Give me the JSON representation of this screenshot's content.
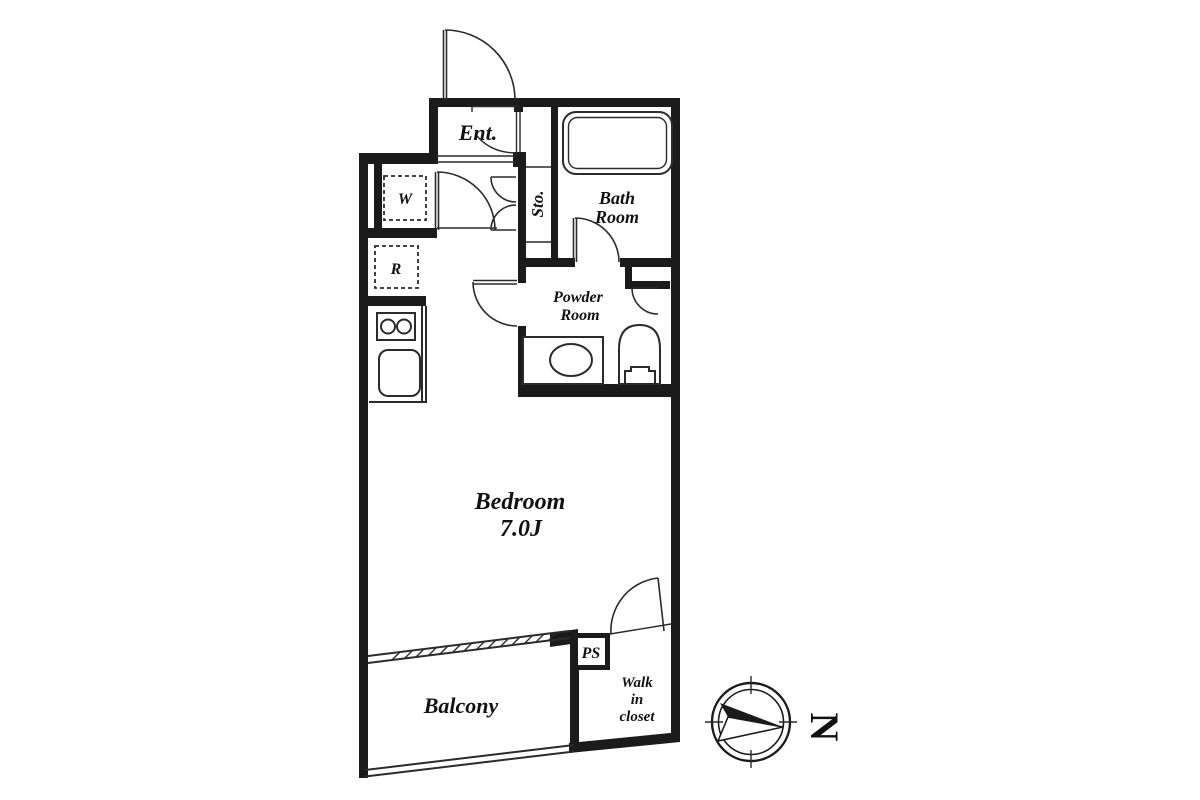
{
  "floorplan": {
    "labels": {
      "entrance": "Ent.",
      "storage": "Sto.",
      "bath_line1": "Bath",
      "bath_line2": "Room",
      "powder_line1": "Powder",
      "powder_line2": "Room",
      "bedroom_line1": "Bedroom",
      "bedroom_line2": "7.0J",
      "balcony": "Balcony",
      "pipe_shaft": "PS",
      "walkin_line1": "Walk",
      "walkin_line2": "in",
      "walkin_line3": "closet",
      "washing_machine": "W",
      "refrigerator": "R"
    },
    "compass": {
      "north_label": "N"
    },
    "colors": {
      "wall": "#1b1b1b",
      "line": "#2b2b2b",
      "text": "#111111",
      "background": "#ffffff"
    }
  }
}
